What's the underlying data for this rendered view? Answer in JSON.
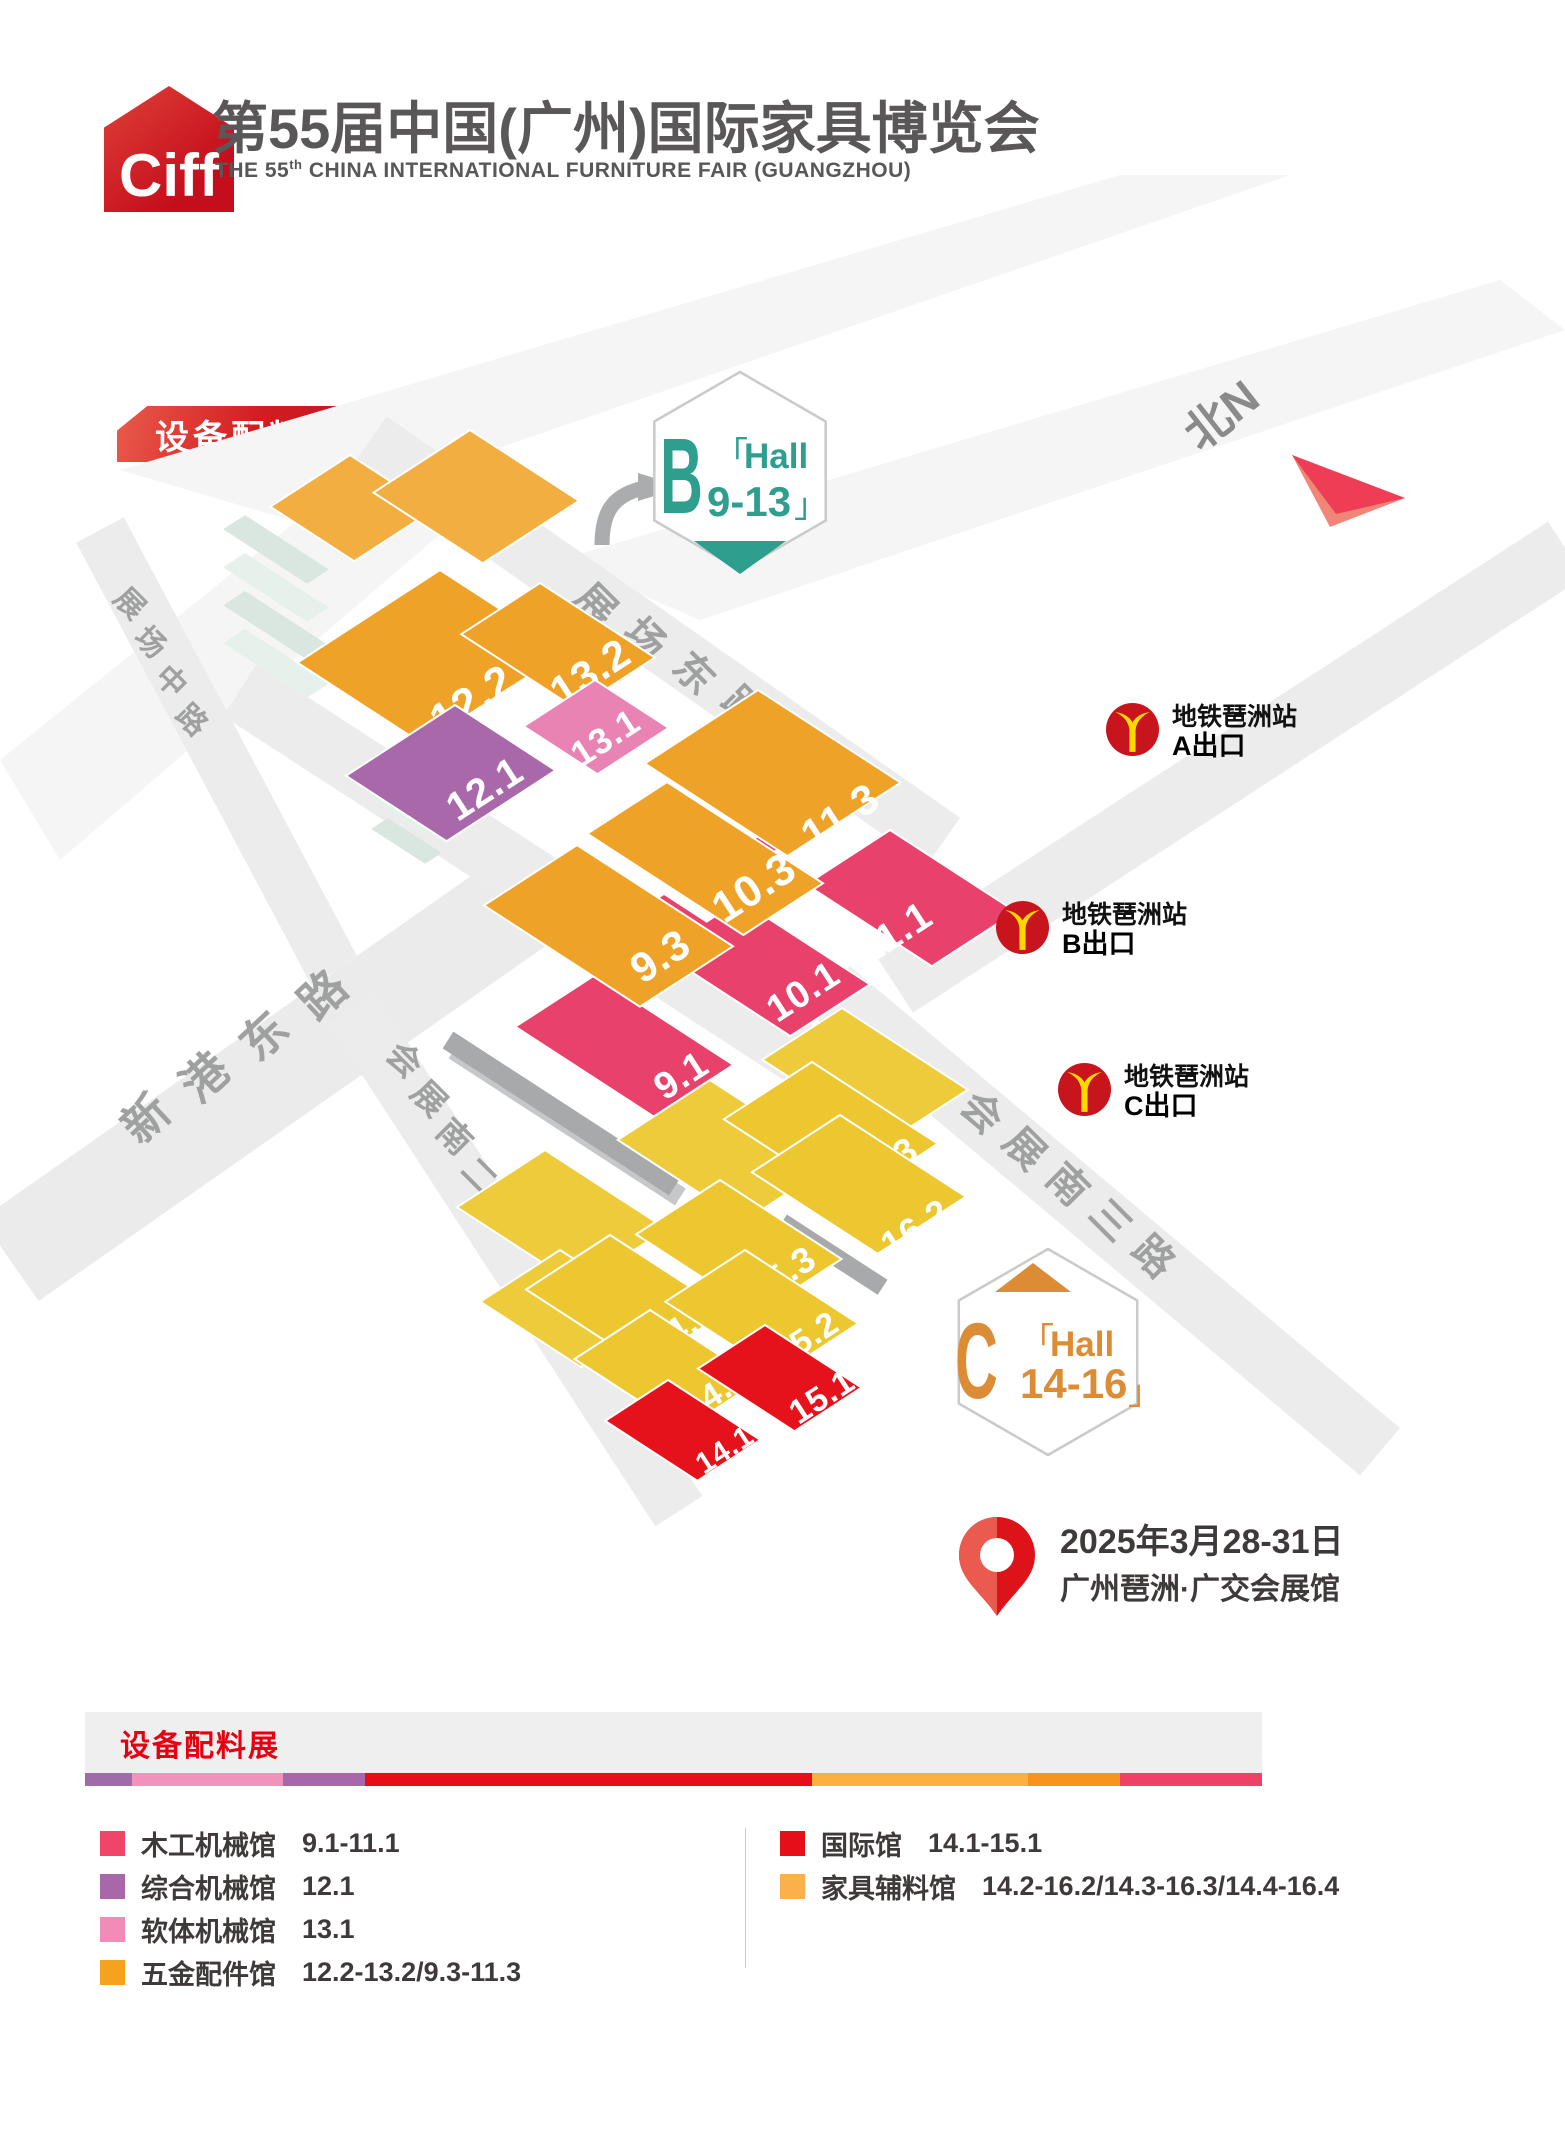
{
  "header": {
    "logo_text": "Ciff",
    "title": "第55届中国(广州)国际家具博览会",
    "subtitle_prefix": "THE 55",
    "subtitle_sup": "th",
    "subtitle_rest": " CHINA INTERNATIONAL FURNITURE FAIR (GUANGZHOU)"
  },
  "expo_badge": {
    "label": "设备配料展"
  },
  "compass": {
    "label": "北N"
  },
  "hall_badge_b": {
    "letter": "B",
    "bracket_open": "「",
    "hall_word": "Hall",
    "range": "9-13",
    "bracket_close": "」"
  },
  "hall_badge_c": {
    "letter": "C",
    "bracket_open": "「",
    "hall_word": "Hall",
    "range": "14-16",
    "bracket_close": "」"
  },
  "map": {
    "streets": [
      {
        "name": "展场东路"
      },
      {
        "name": "展场中路"
      },
      {
        "name": "新港东路"
      },
      {
        "name": "会展南三路"
      },
      {
        "name": "会展南二路"
      }
    ],
    "halls": [
      {
        "label": "12.2",
        "color": "#EFA228"
      },
      {
        "label": "13.2",
        "color": "#EFA228"
      },
      {
        "label": "12.1",
        "color": "#A968AA"
      },
      {
        "label": "13.1",
        "color": "#E983B4"
      },
      {
        "label": "9.3",
        "color": "#EFA228"
      },
      {
        "label": "10.3",
        "color": "#EFA228"
      },
      {
        "label": "11.3",
        "color": "#EFA228"
      },
      {
        "label": "9.1",
        "color": "#E8416B"
      },
      {
        "label": "10.1",
        "color": "#E8416B"
      },
      {
        "label": "11.1",
        "color": "#E8416B"
      },
      {
        "label": "16.3",
        "color": "#EDC72F"
      },
      {
        "label": "16.2",
        "color": "#EDC72F"
      },
      {
        "label": "15.3",
        "color": "#EDC72F"
      },
      {
        "label": "14.3",
        "color": "#EDC72F"
      },
      {
        "label": "15.2",
        "color": "#EDC72F"
      },
      {
        "label": "14.2",
        "color": "#EDC72F"
      },
      {
        "label": "14.1",
        "color": "#E6121B"
      },
      {
        "label": "15.1",
        "color": "#E6121B"
      }
    ]
  },
  "metro": {
    "station": "地铁琶洲站",
    "exits": [
      {
        "label": "A出口"
      },
      {
        "label": "B出口"
      },
      {
        "label": "C出口"
      }
    ]
  },
  "event": {
    "date": "2025年3月28-31日",
    "venue": "广州琶洲·广交会展馆"
  },
  "legend": {
    "title": "设备配料展",
    "bar_colors": [
      "#9F6BA8",
      "#F192BD",
      "#A668A8",
      "#E60E19",
      "#FBB040",
      "#F7941E",
      "#EF4166"
    ],
    "left_items": [
      {
        "name": "木工机械馆",
        "range": "9.1-11.1",
        "color": "#EF4568"
      },
      {
        "name": "综合机械馆",
        "range": "12.1",
        "color": "#A767A9"
      },
      {
        "name": "软体机械馆",
        "range": "13.1",
        "color": "#F18CB8"
      },
      {
        "name": "五金配件馆",
        "range": "12.2-13.2/9.3-11.3",
        "color": "#F7A21C"
      }
    ],
    "right_items": [
      {
        "name": "国际馆",
        "range": "14.1-15.1",
        "color": "#E60E19"
      },
      {
        "name": "家具辅料馆",
        "range": "14.2-16.2/14.3-16.3/14.4-16.4",
        "color": "#FBB04B"
      }
    ]
  },
  "palette": {
    "brand_red": "#E60012",
    "teal": "#2E9E8F",
    "hall_c_orange": "#DC8C35",
    "metro_red": "#C8151D",
    "metro_yellow": "#FFD800",
    "pin_red_dark": "#DE1219",
    "pin_red_light": "#EA5A4F",
    "compass_dark": "#EE3D55",
    "compass_light": "#F08578"
  }
}
